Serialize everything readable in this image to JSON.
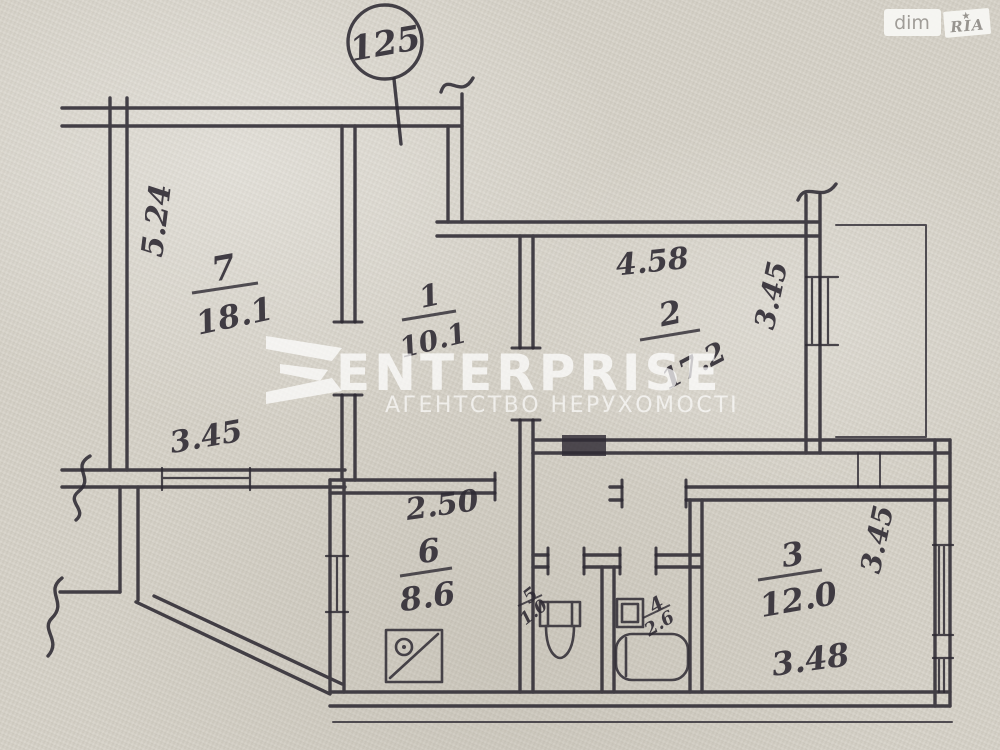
{
  "colors": {
    "paper": "#d6d2c8",
    "ink": "#2e2a33",
    "watermark": "#ffffff"
  },
  "header": {
    "apartment_circle": "125",
    "badges": {
      "dim": "dim",
      "ria": "RIA",
      "ria_star": "★"
    }
  },
  "watermark": {
    "title": "ENTERPRISE",
    "subtitle": "АГЕНТСТВО НЕРУХОМОСТІ"
  },
  "rooms": {
    "room7": {
      "number": "7",
      "area": "18.1"
    },
    "room1": {
      "number": "1",
      "area": "10.1"
    },
    "room2": {
      "number": "2",
      "area": "17.2"
    },
    "room3": {
      "number": "3",
      "area": "12.0"
    },
    "room6": {
      "number": "6",
      "area": "8.6"
    },
    "room5_wc": {
      "number": "5",
      "area": "1.0"
    },
    "room4_bath": {
      "number": "4",
      "area": "2.6"
    }
  },
  "dimensions": {
    "room7_left": "5.24",
    "hall_window": "3.45",
    "room2_top": "4.58",
    "room2_right": "3.45",
    "room6_top": "2.50",
    "room3_width": "3.48",
    "room3_right": "3.45"
  }
}
